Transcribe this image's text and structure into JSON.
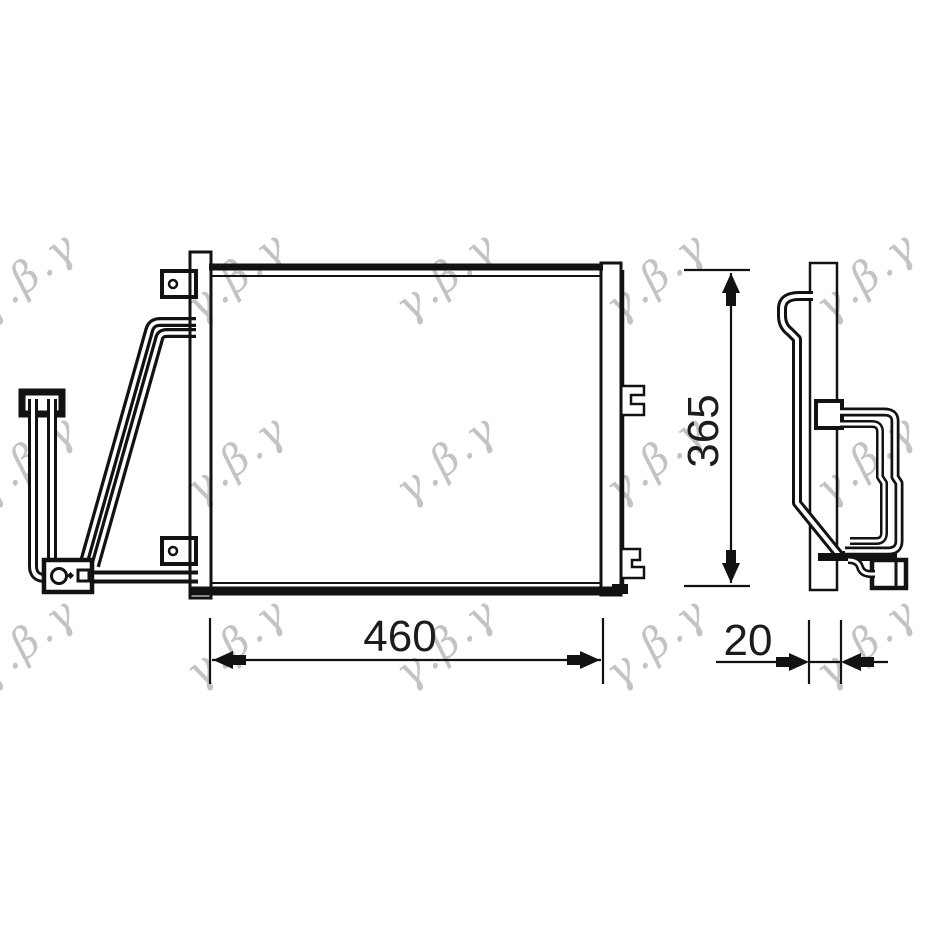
{
  "colors": {
    "background": "#ffffff",
    "line": "#121212",
    "dimension_text": "#1c1c1c",
    "watermark": "#bdbdbd"
  },
  "watermark": {
    "text": "γ.β.γ"
  },
  "dims": {
    "width": {
      "label": "460"
    },
    "height": {
      "label": "365"
    },
    "depth": {
      "label": "20"
    }
  }
}
